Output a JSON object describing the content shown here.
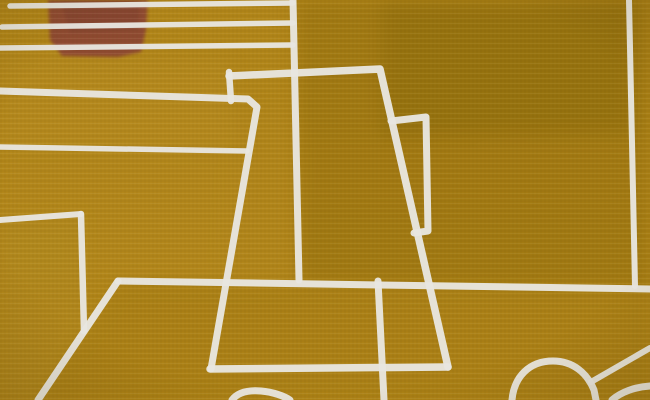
{
  "artwork": {
    "description": "Abstract ochre painting: white outline drawing of a coffee pot on a table, horizontal white stripes and a rust-red rectangle in the upper left, rounded cup shapes along the bottom edge",
    "palette": {
      "ochre_base": "#b28619",
      "ochre_right": "#9c7610",
      "ochre_dark": "#8e6c0c",
      "ochre_light": "#bb9025",
      "ochre_left_mid": "#b78d22",
      "ochre_table": "#a37a12",
      "ochre_bottom_left": "#b18a24",
      "ochre_pot_interior": "#b28820",
      "ochre_right_band": "#a57d15",
      "line_white": "#e8e6e0",
      "red_patch": "#8f4a31",
      "red_patch_dark": "#7e4130"
    },
    "tone_patches": [
      {
        "name": "tone-right-block",
        "fill": "ochre_right",
        "opacity": 0.75,
        "points": [
          [
            296,
            0
          ],
          [
            650,
            0
          ],
          [
            650,
            288
          ],
          [
            299,
            282
          ]
        ]
      },
      {
        "name": "tone-right-band",
        "fill": "ochre_right_band",
        "opacity": 0.4,
        "points": [
          [
            300,
            135
          ],
          [
            650,
            140
          ],
          [
            650,
            210
          ],
          [
            300,
            205
          ]
        ]
      },
      {
        "name": "tone-top-right-dark",
        "fill": "ochre_dark",
        "opacity": 0.5,
        "points": [
          [
            382,
            0
          ],
          [
            632,
            0
          ],
          [
            632,
            132
          ],
          [
            382,
            138
          ]
        ]
      },
      {
        "name": "tone-left-light-band",
        "fill": "ochre_light",
        "opacity": 0.35,
        "points": [
          [
            0,
            55
          ],
          [
            230,
            60
          ],
          [
            235,
            150
          ],
          [
            0,
            150
          ]
        ]
      },
      {
        "name": "tone-left-mid",
        "fill": "ochre_left_mid",
        "opacity": 0.28,
        "points": [
          [
            0,
            150
          ],
          [
            248,
            152
          ],
          [
            228,
            280
          ],
          [
            0,
            282
          ]
        ]
      },
      {
        "name": "tone-pot-interior",
        "fill": "ochre_pot_interior",
        "opacity": 0.25,
        "points": [
          [
            235,
            110
          ],
          [
            290,
            108
          ],
          [
            290,
            275
          ],
          [
            222,
            275
          ]
        ]
      },
      {
        "name": "tone-table",
        "fill": "ochre_table",
        "opacity": 0.4,
        "points": [
          [
            120,
            283
          ],
          [
            650,
            291
          ],
          [
            650,
            400
          ],
          [
            40,
            400
          ]
        ]
      },
      {
        "name": "tone-bottom-left",
        "fill": "ochre_bottom_left",
        "opacity": 0.3,
        "points": [
          [
            0,
            222
          ],
          [
            80,
            216
          ],
          [
            84,
            331
          ],
          [
            40,
            398
          ],
          [
            0,
            400
          ]
        ]
      }
    ],
    "red_patches": [
      {
        "name": "red-rectangle",
        "fill": "red_patch",
        "opacity": 1.0,
        "points": [
          [
            48,
            0
          ],
          [
            148,
            0
          ],
          [
            146,
            30
          ],
          [
            141,
            52
          ],
          [
            118,
            57
          ],
          [
            62,
            56
          ],
          [
            50,
            40
          ]
        ]
      },
      {
        "name": "red-rectangle-shade",
        "fill": "red_patch_dark",
        "opacity": 0.45,
        "points": [
          [
            60,
            0
          ],
          [
            140,
            0
          ],
          [
            138,
            30
          ],
          [
            70,
            33
          ]
        ]
      }
    ],
    "lines": [
      {
        "name": "stripe-1",
        "width": 5.5,
        "points": [
          [
            10,
            6
          ],
          [
            293,
            3
          ]
        ]
      },
      {
        "name": "stripe-2",
        "width": 5.5,
        "points": [
          [
            2,
            27
          ],
          [
            293,
            23
          ]
        ]
      },
      {
        "name": "stripe-3",
        "width": 5.5,
        "points": [
          [
            0,
            48
          ],
          [
            293,
            45
          ]
        ]
      },
      {
        "name": "stripe-4-and-pot-left-edge",
        "width": 7,
        "points": [
          [
            0,
            91
          ],
          [
            248,
            99
          ],
          [
            257,
            107
          ],
          [
            211,
            369
          ]
        ]
      },
      {
        "name": "stripe-5",
        "width": 5.5,
        "points": [
          [
            0,
            147
          ],
          [
            247,
            151
          ]
        ]
      },
      {
        "name": "pot-lid-top-and-right-edge",
        "width": 7.5,
        "points": [
          [
            229,
            76
          ],
          [
            380,
            69
          ],
          [
            448,
            367
          ]
        ]
      },
      {
        "name": "pot-lid-left-edge",
        "width": 6.5,
        "points": [
          [
            229,
            72
          ],
          [
            231,
            101
          ]
        ]
      },
      {
        "name": "pot-handle-outline",
        "width": 7,
        "points": [
          [
            391,
            121
          ],
          [
            426,
            117
          ],
          [
            428,
            231
          ],
          [
            414,
            233
          ]
        ]
      },
      {
        "name": "pot-bottom-edge",
        "width": 7.5,
        "points": [
          [
            210,
            369
          ],
          [
            448,
            367
          ]
        ]
      },
      {
        "name": "pot-center-vertical",
        "width": 7,
        "points": [
          [
            293,
            0
          ],
          [
            299,
            280
          ]
        ]
      },
      {
        "name": "pot-base-vertical",
        "width": 7,
        "points": [
          [
            378,
            281
          ],
          [
            384,
            400
          ]
        ]
      },
      {
        "name": "table-back-edge",
        "width": 7,
        "points": [
          [
            118,
            281
          ],
          [
            650,
            289
          ]
        ]
      },
      {
        "name": "table-left-diagonal",
        "width": 7,
        "points": [
          [
            118,
            281
          ],
          [
            38,
            400
          ]
        ]
      },
      {
        "name": "wall-left-horizontal",
        "width": 6,
        "points": [
          [
            0,
            220
          ],
          [
            81,
            214
          ]
        ]
      },
      {
        "name": "wall-left-vertical",
        "width": 6.5,
        "points": [
          [
            81,
            214
          ],
          [
            84,
            331
          ]
        ]
      },
      {
        "name": "right-edge-vertical",
        "width": 6,
        "points": [
          [
            629,
            0
          ],
          [
            635,
            286
          ]
        ]
      },
      {
        "name": "dome-right-diagonal",
        "width": 6,
        "points": [
          [
            591,
            382
          ],
          [
            650,
            348
          ]
        ]
      }
    ],
    "curves": [
      {
        "name": "bottom-center-cup-arc",
        "width": 7,
        "d": "M 232 400 C 238 392 249 390 261 391 C 273 392 284 396 290 400"
      },
      {
        "name": "bottom-right-dome",
        "width": 7,
        "d": "M 512 400 C 514 377 529 361 553 361 C 573 361 587 373 594 390 L 596 400"
      },
      {
        "name": "bottom-corner-arc",
        "width": 7,
        "d": "M 612 400 C 621 392 635 387 650 386"
      }
    ]
  }
}
